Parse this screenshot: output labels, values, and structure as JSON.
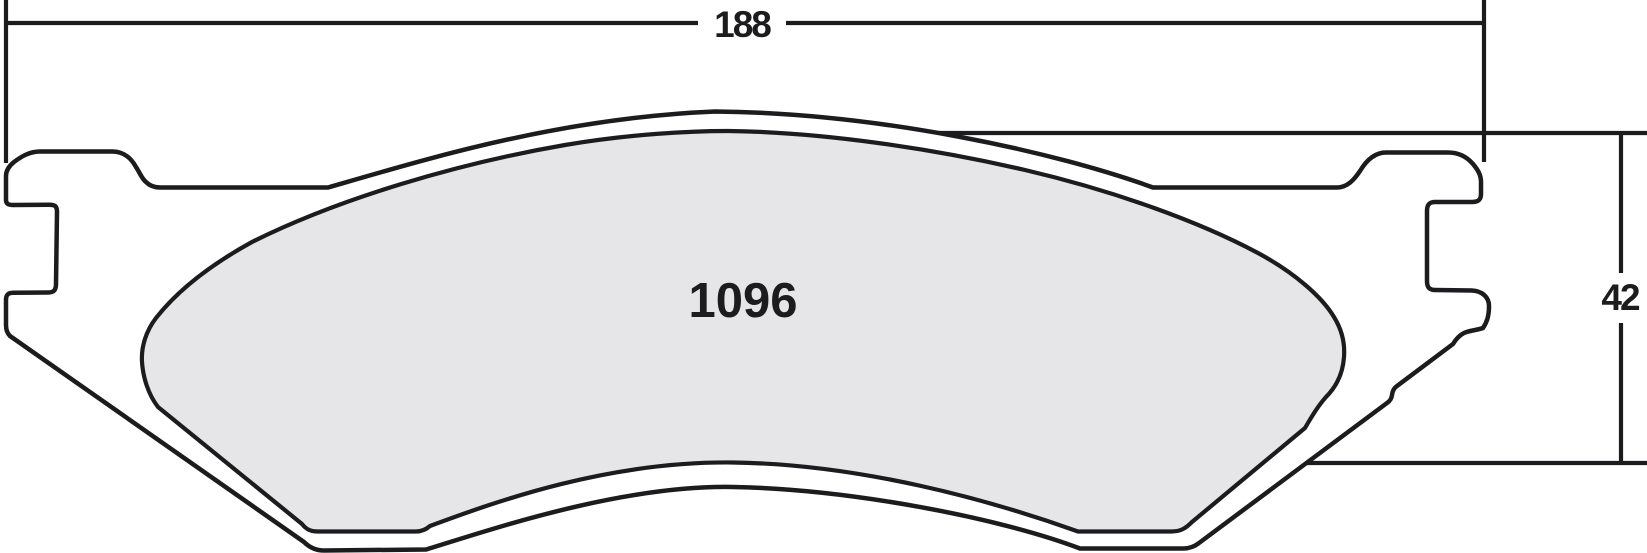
{
  "diagram": {
    "type": "brake-pad-shape-drawing",
    "part_number": "1096",
    "dimensions": {
      "overall_width": "188",
      "pad_height": "42"
    },
    "colors": {
      "line": "#1c1c1e",
      "plate_fill": "#ffffff",
      "friction_fill": "#e6e6e8",
      "background": "#ffffff"
    }
  }
}
